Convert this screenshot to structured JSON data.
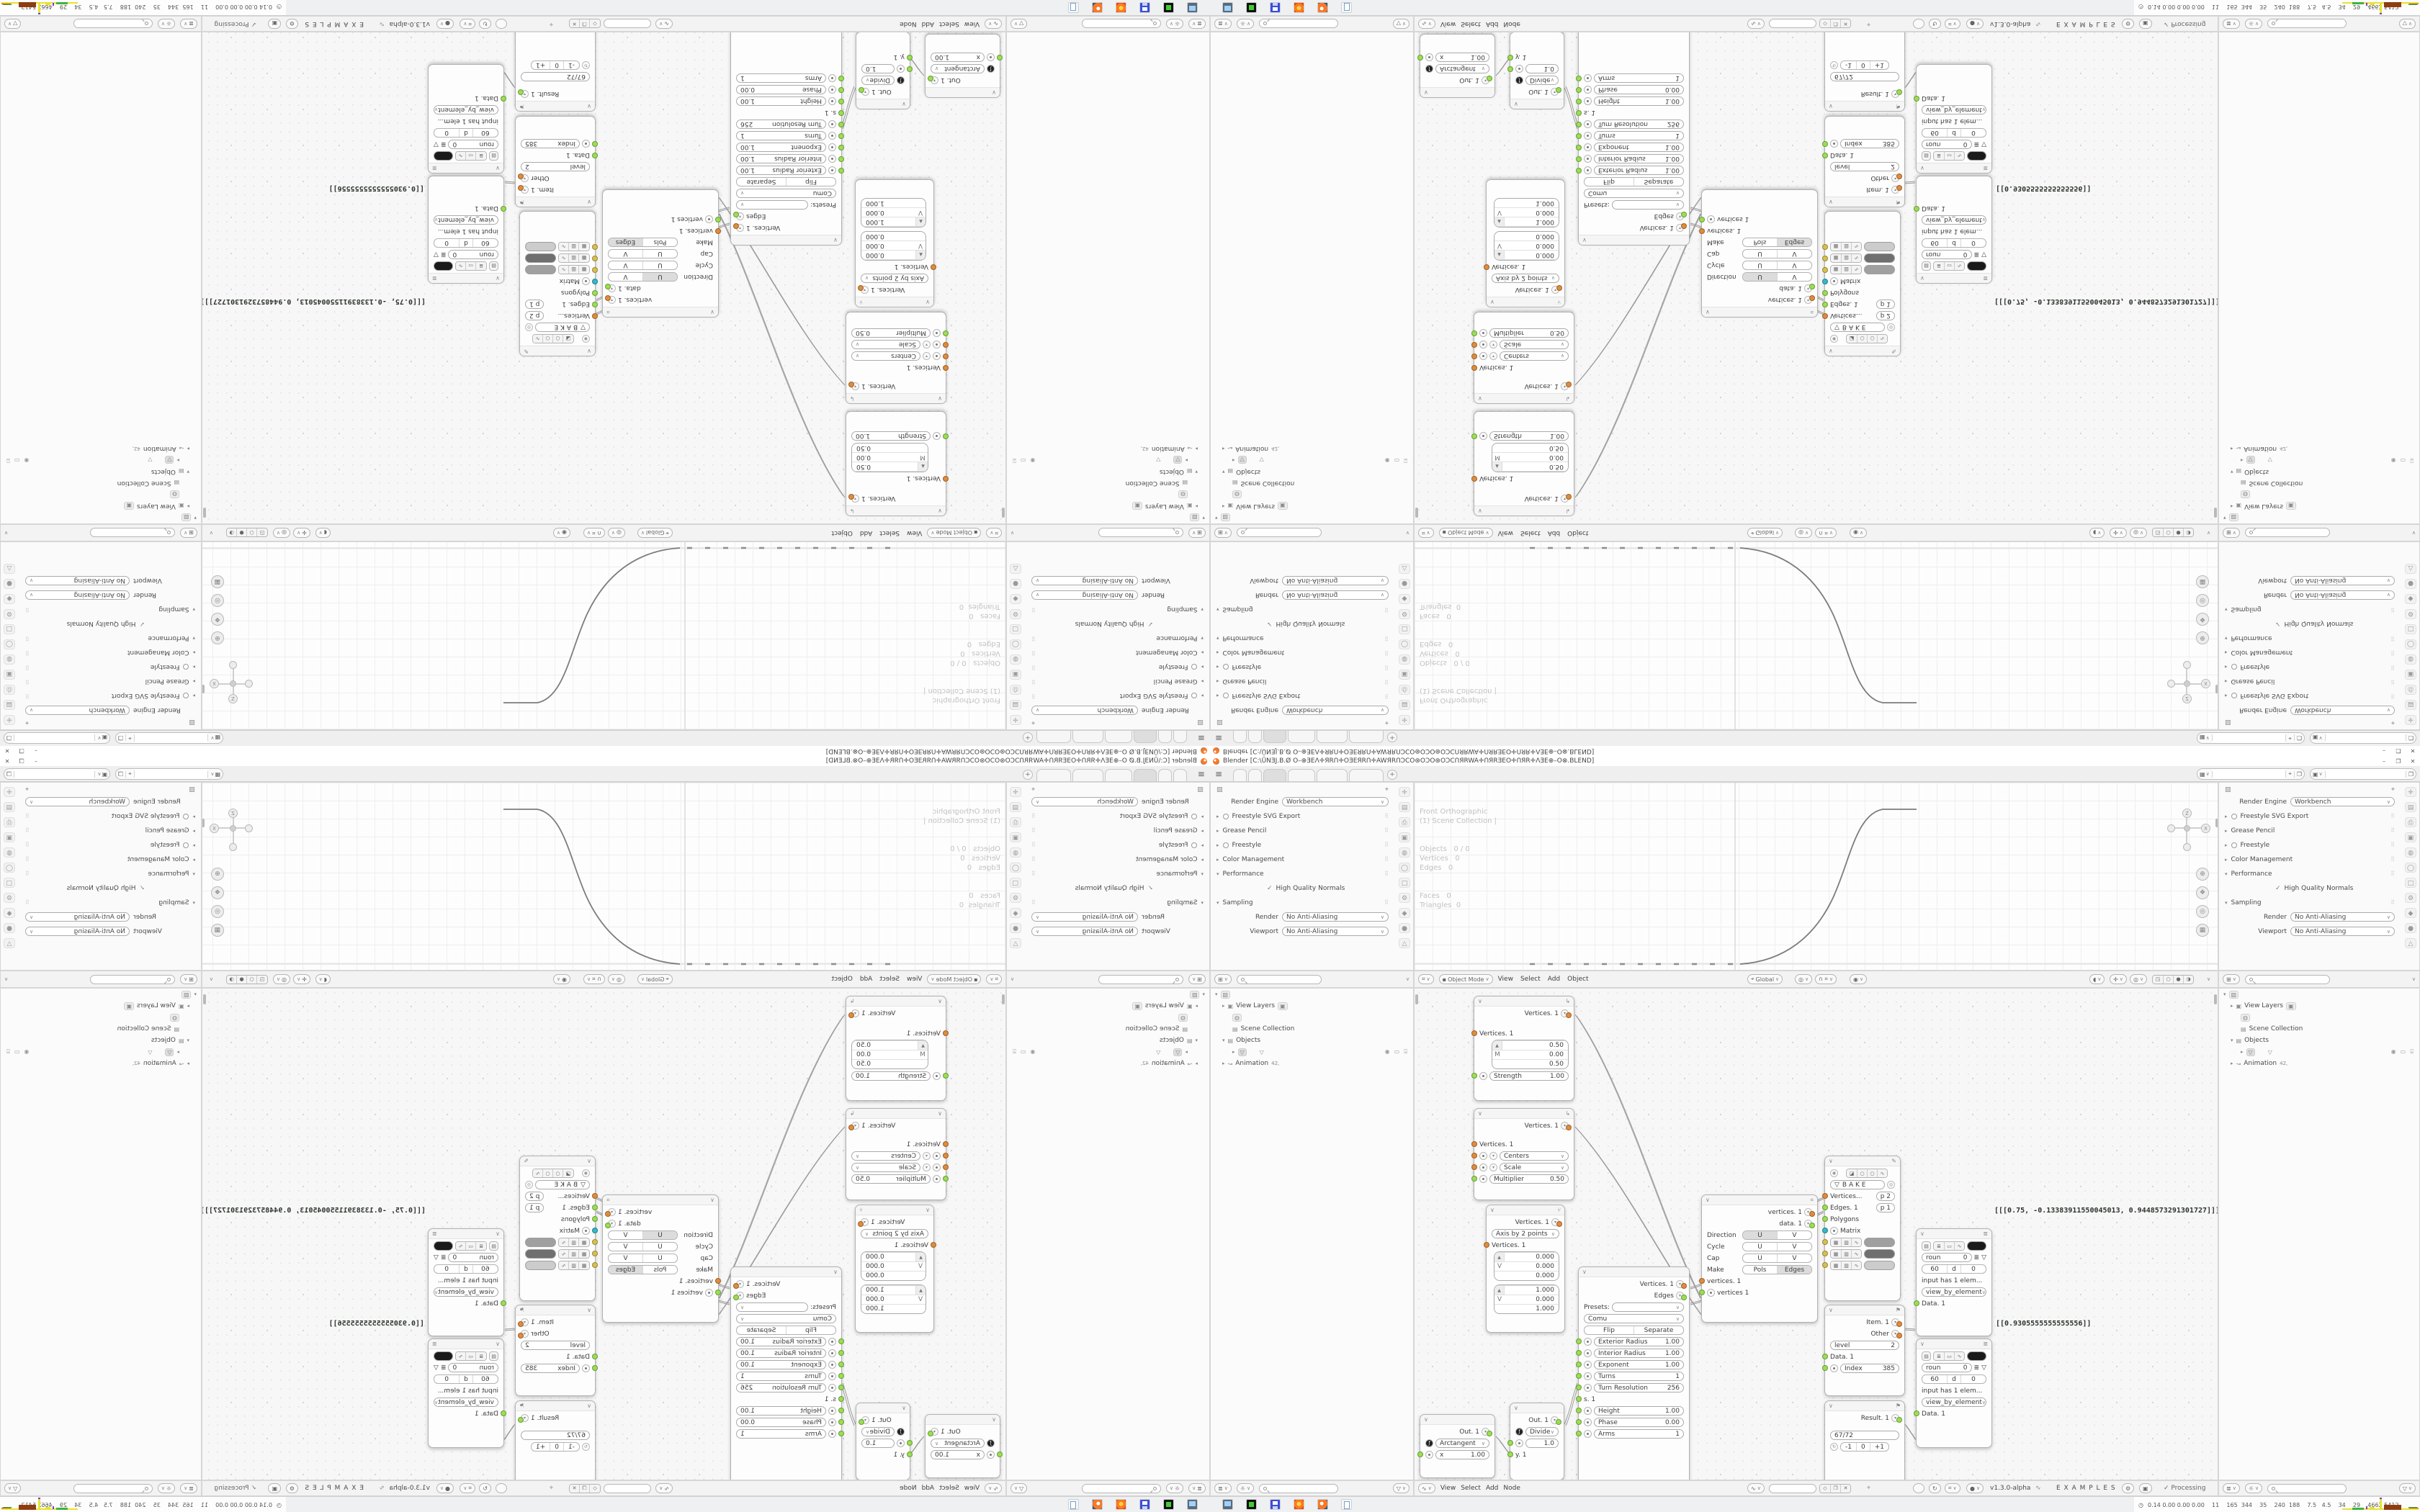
{
  "window": {
    "title": "Blender [C:\\ŪNƎJ.B.Ø O–⊕ƎEΛ✛ЯRՈ✛OƎEЯRՈ✛AWЯRՈƆCO⊛OƆO⊛OƆCՈЯRWA✛ՈЯRƎEO✛ՈЯR✛ΛƎE⊕–O⊗.BLEND]",
    "minimize": "–",
    "restore": "❐",
    "close": "✕"
  },
  "topbar": {
    "menu_icon": "≡",
    "add_tab": "+"
  },
  "properties": {
    "render_engine_label": "Render Engine",
    "render_engine": "Workbench",
    "freestyle_svg": "Freestyle SVG Export",
    "grease_pencil": "Grease Pencil",
    "freestyle": "Freestyle",
    "color_management": "Color Management",
    "performance": "Performance",
    "high_quality_normals": "High Quality Normals",
    "sampling": "Sampling",
    "render_label": "Render",
    "viewport_label": "Viewport",
    "render_aa": "No Anti-Aliasing",
    "viewport_aa": "No Anti-Aliasing"
  },
  "viewport": {
    "overlay": [
      "Front Orthographic",
      "(1) Scene Collection |",
      "",
      "Objects   0 / 0",
      "Vertices   0",
      "Edges   0",
      "Faces   0",
      "Triangles  0"
    ],
    "header": {
      "mode": "Object Mode",
      "view": "View",
      "select": "Select",
      "add": "Add",
      "object": "Object",
      "orientation": "Global"
    },
    "gizmo": {
      "z": "Z",
      "x": "X"
    }
  },
  "outliner": {
    "view_layers": "View Layers",
    "scene_collection": "Scene Collection",
    "objects": "Objects",
    "animation": "Animation",
    "anim_badge": "42,"
  },
  "node_editor": {
    "header": {
      "view": "View",
      "select": "Select",
      "add": "Add",
      "node": "Node",
      "version": "v1.3.0-alpha",
      "tree_name": "E X A M P L E S",
      "processing": "Processing"
    },
    "nodes": {
      "move": {
        "out": "Vertices. 1",
        "in": "Vertices. 1",
        "vx": "0.50",
        "m": "M",
        "vy": "0.00",
        "vz": "0.50",
        "strength_label": "Strength",
        "strength_value": "1.00"
      },
      "scale": {
        "out": "Vertices. 1",
        "in": "Vertices. 1",
        "centers": "Centers",
        "scale": "Scale",
        "multiplier_label": "Multiplier",
        "multiplier_value": "0.50"
      },
      "axis": {
        "out": "Vertices. 1",
        "mode": "Axis by 2 points",
        "in": "Vertices. 1",
        "v1x": "0.000",
        "v1m": "V",
        "v1y": "0.000",
        "v1z": "0.000",
        "v2x": "1.000",
        "v2m": "V",
        "v2y": "0.000",
        "v2z": "1.000"
      },
      "arctangent": {
        "out": "Out. 1",
        "fn": "Arctangent",
        "x_label": "x",
        "x_value": "1.00",
        "fsym": "ƒ"
      },
      "divide": {
        "out": "Out. 1",
        "fn": "Divide",
        "in1": "1.0",
        "in2": "y. 1",
        "fsym": "ƒ"
      },
      "cornu": {
        "out1": "Vertices. 1",
        "out2": "Edges",
        "presets_label": "Presets:",
        "profile": "Comu",
        "flip": "Flip",
        "separate": "Separate",
        "params1": [
          {
            "l": "Exterior Radius",
            "v": "1.00"
          },
          {
            "l": "Interior Radius",
            "v": "1.00"
          },
          {
            "l": "Exponent",
            "v": "1.00"
          },
          {
            "l": "Turns",
            "v": "1"
          },
          {
            "l": "Turn Resolution",
            "v": "256"
          }
        ],
        "s_label": "s. 1",
        "params2": [
          {
            "l": "Height",
            "v": "1.00"
          },
          {
            "l": "Phase",
            "v": "0.00"
          },
          {
            "l": "Arms",
            "v": "1"
          }
        ]
      },
      "uv_connect": {
        "out1": "vertices. 1",
        "out2": "data. 1",
        "r1": "Direction",
        "r2": "Cycle",
        "r3": "Cap",
        "r4": "Make",
        "u": "U",
        "v": "V",
        "pols": "Pols",
        "edges": "Edges",
        "in1": "vertices. 1",
        "in2": "vertices 1"
      },
      "viewer_draw": {
        "bake": "B A K E",
        "in1": "Vertices...",
        "in1b": "p  2",
        "in2": "Edges. 1",
        "in2b": "p  1",
        "in3": "Polygons",
        "in4": "Matrix"
      },
      "list_item": {
        "out1": "Item. 1",
        "out2": "Other",
        "level_label": "level",
        "level_value": "2",
        "in1": "Data. 1",
        "in2_label": "Index",
        "in2_value": "385"
      },
      "counter": {
        "out": "Result. 1",
        "value": "67/72",
        "minus": "-1",
        "zero": "0",
        "plus": "+1"
      },
      "steth1": {
        "roun": "roun",
        "n0": "0",
        "v60": "60",
        "d": "d",
        "d0": "0",
        "info": "input has 1 elem...",
        "mode": "view_by_element",
        "in": "Data. 1",
        "output_text": "[[[0.75, -0.13383911550045013, 0.9448573291301727]]]"
      },
      "steth2": {
        "roun": "roun",
        "n0": "0",
        "v60": "60",
        "d": "d",
        "d0": "0",
        "info": "input has 1 elem...",
        "mode": "view_by_element",
        "in": "Data. 1",
        "output_text": "[[0.9305555555555556]]"
      }
    }
  },
  "status": {
    "clock_icon": "◷",
    "numbers": "0.14 0.00 0.00 0.00    11    165  344    35    240  188    7.5   4.5    34    29    4662 5412"
  },
  "colors": {
    "socket_orange": "#e08c3c",
    "socket_green": "#9adf52",
    "socket_cyan": "#35b8c9",
    "socket_yellow": "#d8c050",
    "hist_yellow": "#e6e231",
    "hist_green": "#3db53d",
    "hist_brown": "#8e3c10",
    "hist_purple": "#7a3bd6"
  }
}
